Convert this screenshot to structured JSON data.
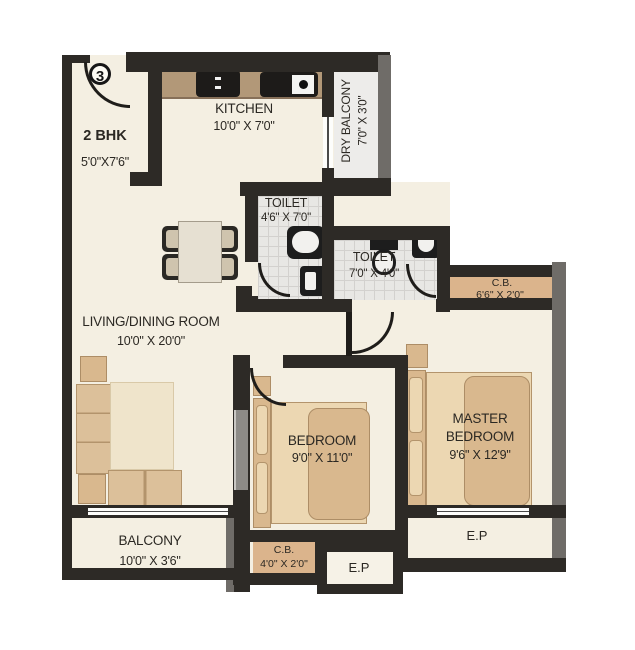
{
  "plan": {
    "unit_number": "3",
    "unit_type": "2 BHK",
    "entry_dims": "5'0\"X7'6\"",
    "rooms": {
      "kitchen": {
        "name": "KITCHEN",
        "dims": "10'0\" X 7'0\""
      },
      "dry_balcony": {
        "name": "DRY BALCONY",
        "dims": "7'0\" X 3'0\""
      },
      "toilet_1": {
        "name": "TOILET",
        "dims": "4'6\" X 7'0\""
      },
      "toilet_2": {
        "name": "TOILET",
        "dims": "7'0\" X 4'0\""
      },
      "cupboard_top": {
        "name": "C.B.",
        "dims": "6'6\" X 2'0\""
      },
      "living_dining": {
        "name": "LIVING/DINING ROOM",
        "dims": "10'0\" X 20'0\""
      },
      "bedroom": {
        "name": "BEDROOM",
        "dims": "9'0\" X 11'0\""
      },
      "master_bedroom": {
        "name": "MASTER BEDROOM",
        "dims": "9'6\" X 12'9\""
      },
      "balcony": {
        "name": "BALCONY",
        "dims": "10'0\" X 3'6\""
      },
      "cupboard_bottom": {
        "name": "C.B.",
        "dims": "4'0\" X 2'0\""
      },
      "ep_bottom": {
        "name": "E.P"
      },
      "ep_right": {
        "name": "E.P"
      }
    },
    "colors": {
      "wall_dark": "#2d2a26",
      "wall_grey": "#6f6c68",
      "floor_cream": "#f4efe2",
      "toilet_tile": "#e8e7e4",
      "cupboard_tan": "#dbb48c",
      "kitchen_counter": "#b29878",
      "furniture_light": "#ecd7b2",
      "furniture_dark": "#d9b88e"
    }
  }
}
